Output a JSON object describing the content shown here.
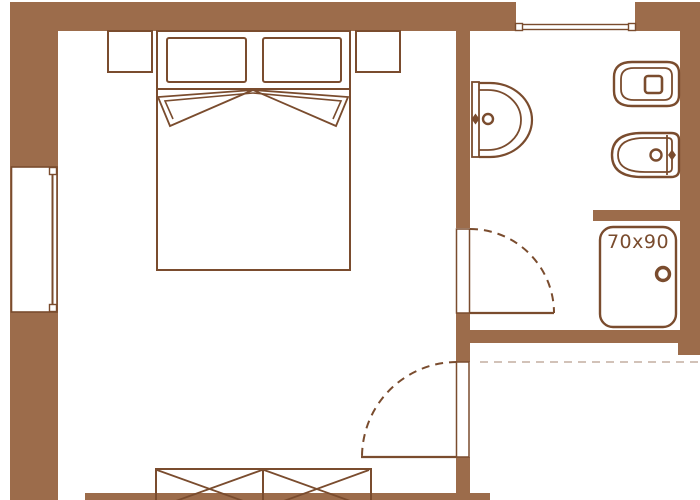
{
  "plan": {
    "type": "floor-plan",
    "shower_label": "70x90",
    "colors": {
      "wall": "#9c6c4b",
      "line": "#7a4c2e",
      "background": "#ffffff"
    },
    "rooms": [
      {
        "name": "bedroom"
      },
      {
        "name": "bathroom"
      }
    ],
    "fixtures": [
      "double-bed",
      "pillow-left",
      "pillow-right",
      "nightstand-left",
      "nightstand-right",
      "wardrobe",
      "washbasin",
      "toilet",
      "bidet",
      "shower-tray",
      "shower-drain",
      "window-left",
      "window-top",
      "bathroom-door",
      "bedroom-door"
    ]
  }
}
